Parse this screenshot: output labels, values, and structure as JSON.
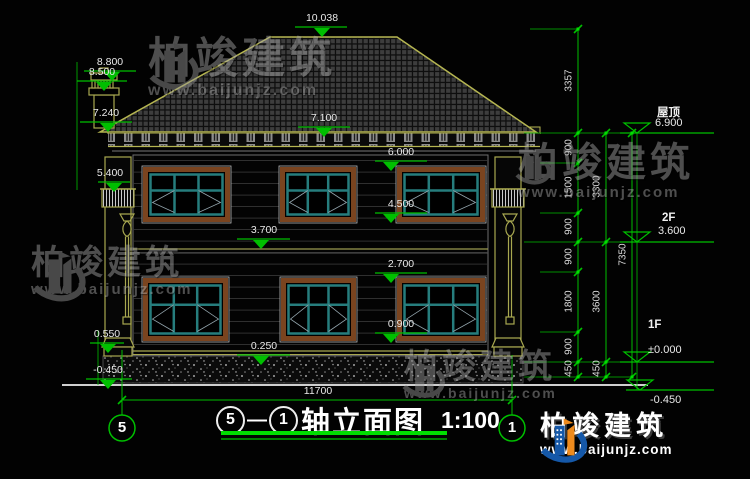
{
  "watermark": {
    "brand": "柏竣建筑",
    "url": "www.baijunjz.com"
  },
  "logo": {
    "brand": "柏竣建筑",
    "url": "www.baijunjz.com"
  },
  "title": {
    "axis_from": "5",
    "sep": "—",
    "axis_to": "1",
    "name": "轴立面图",
    "scale": "1:100"
  },
  "axis_bubbles": {
    "left": "5",
    "right": "1"
  },
  "dims": {
    "overall_width": "11700",
    "elevations": [
      "10.038",
      "8.800",
      "8.500",
      "7.240",
      "5.400",
      "7.100",
      "6.000",
      "4.500",
      "3.700",
      "2.700",
      "0.900",
      "0.250",
      "0.550",
      "-0.450"
    ],
    "chain_inner": [
      "3357",
      "900",
      "1500",
      "900",
      "900",
      "1800",
      "900",
      "450"
    ],
    "chain_middle": [
      "3300",
      "3600",
      "450"
    ],
    "chain_outer": [
      "7350"
    ]
  },
  "levels": {
    "roof_label": "屋顶",
    "roof_value": "6.900",
    "f2_label": "2F",
    "f2_value": "3.600",
    "f1_label": "1F",
    "f1_value": "±0.000",
    "below_value": "-0.450"
  }
}
